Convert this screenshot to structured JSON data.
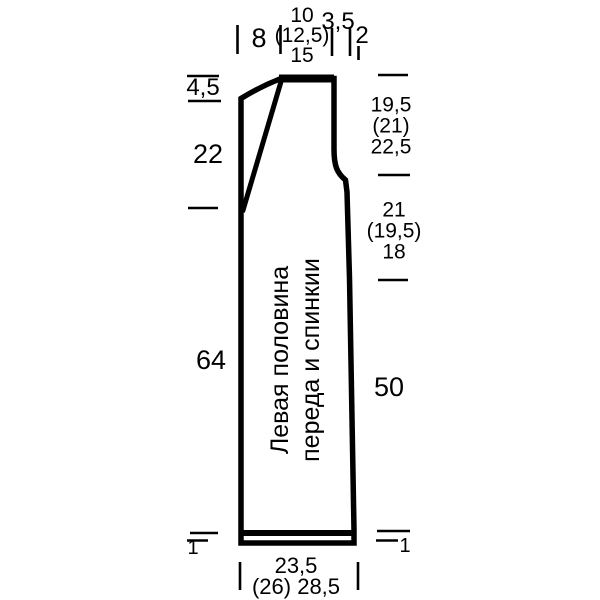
{
  "schematic": {
    "piece_label": {
      "line1": "Левая половина",
      "line2": "переда и спинкии"
    },
    "top": {
      "shoulder_width": "8",
      "neck_stack": [
        "10",
        "(12,5)",
        "15"
      ],
      "armhole_inset": "3,5",
      "side_step": "2"
    },
    "left": {
      "neck_drop": "4,5",
      "neck_slant_depth": "22",
      "body_length": "64",
      "hem_height": "1"
    },
    "right": {
      "upper_stack": [
        "19,5",
        "(21)",
        "22,5"
      ],
      "armhole_stack": [
        "21",
        "(19,5)",
        "18"
      ],
      "side_length": "50",
      "hem_height": "1"
    },
    "bottom": {
      "width_line1": "23,5",
      "width_line2": "(26) 28,5"
    },
    "colors": {
      "line": "#000000",
      "background": "#ffffff"
    }
  }
}
